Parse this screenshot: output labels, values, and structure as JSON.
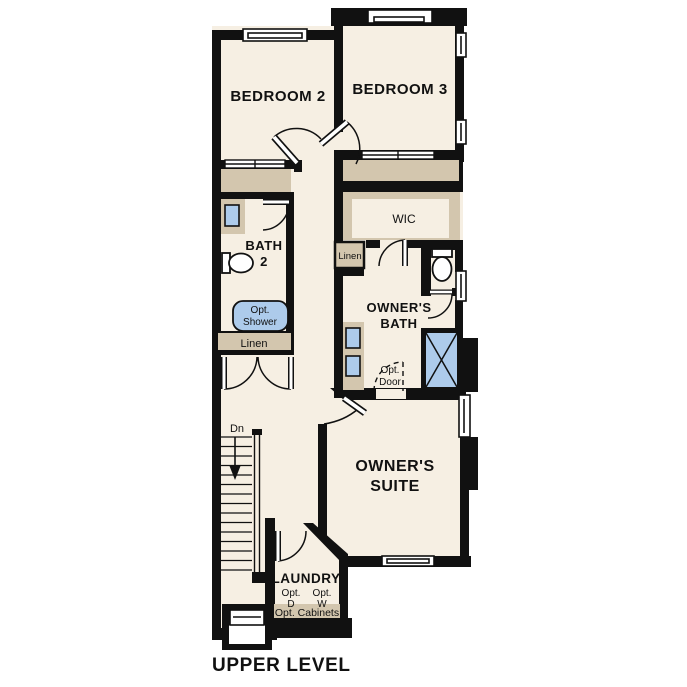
{
  "title": {
    "text": "UPPER LEVEL"
  },
  "colors": {
    "background": "#ffffff",
    "floor": "#f6efe3",
    "wall": "#111111",
    "cabinetry": "#d3c6ae",
    "fixture_blue": "#adcbeb"
  },
  "rooms": {
    "bedroom2": {
      "label": "BEDROOM 2"
    },
    "bedroom3": {
      "label": "BEDROOM 3"
    },
    "bath2": {
      "line1": "BATH",
      "line2": "2"
    },
    "wic": {
      "label": "WIC"
    },
    "owners_bath": {
      "line1": "OWNER'S",
      "line2": "BATH"
    },
    "owners_suite": {
      "line1": "OWNER'S",
      "line2": "SUITE"
    },
    "laundry": {
      "label": "LAUNDRY"
    }
  },
  "features": {
    "hall_linen": {
      "label": "Linen"
    },
    "owners_linen": {
      "label": "Linen"
    },
    "opt_shower": {
      "line1": "Opt.",
      "line2": "Shower"
    },
    "opt_door": {
      "line1": "Opt.",
      "line2": "Door"
    },
    "stairs": {
      "direction_label": "Dn"
    },
    "opt_dryer": {
      "line1": "Opt.",
      "line2": "D"
    },
    "opt_washer": {
      "line1": "Opt.",
      "line2": "W"
    },
    "opt_cabinets": {
      "label": "Opt. Cabinets"
    }
  }
}
